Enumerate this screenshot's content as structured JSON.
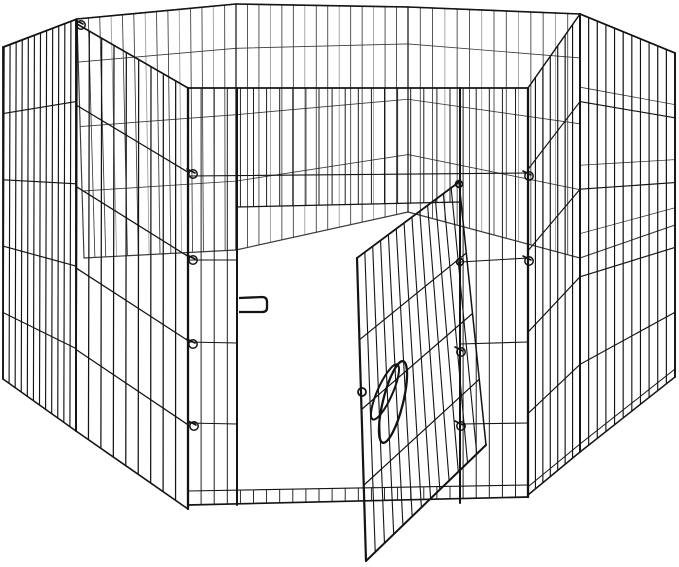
{
  "scene": {
    "description": "Product photo: black metal wire 8-panel octagonal pet exercise playpen with open swing-through door, on white background",
    "canvas": {
      "width": 679,
      "height": 567
    },
    "colors": {
      "background": "#ffffff",
      "wire": "#141414",
      "wire_inner": "#3b3b3b",
      "wire_light": "#9a9a9a"
    }
  },
  "pen": {
    "rim": {
      "pts": [
        [
          3,
          47
        ],
        [
          77,
          19
        ],
        [
          236,
          4
        ],
        [
          408,
          7
        ],
        [
          580,
          14
        ],
        [
          675,
          53
        ]
      ],
      "w": 1.6
    },
    "interior_panels": [
      {
        "name": "back-left-panel",
        "q": [
          [
            77,
            19
          ],
          [
            236,
            4
          ],
          [
            236,
            250
          ],
          [
            84,
            258
          ]
        ],
        "nv": 13,
        "fracs": [
          0.18,
          0.45,
          0.72
        ],
        "w": 0.85,
        "mix": true
      },
      {
        "name": "back-middle-panel",
        "q": [
          [
            236,
            4
          ],
          [
            408,
            7
          ],
          [
            408,
            212
          ],
          [
            236,
            250
          ]
        ],
        "nv": 14,
        "fracs": [
          0.18,
          0.45,
          0.72
        ],
        "w": 0.85,
        "mix": true
      },
      {
        "name": "back-right-panel",
        "q": [
          [
            408,
            7
          ],
          [
            580,
            14
          ],
          [
            580,
            258
          ],
          [
            408,
            212
          ]
        ],
        "nv": 13,
        "fracs": [
          0.18,
          0.45,
          0.72
        ],
        "w": 0.85,
        "mix": true
      },
      {
        "name": "right-inner-panel",
        "q": [
          [
            580,
            14
          ],
          [
            675,
            53
          ],
          [
            675,
            225
          ],
          [
            580,
            258
          ]
        ],
        "nv": 10,
        "fracs": [
          0.3,
          0.62,
          0.9
        ],
        "w": 0.8,
        "mix": true
      }
    ],
    "outer_panels": [
      {
        "name": "left-end-panel",
        "q": [
          [
            4,
            47
          ],
          [
            77,
            19
          ],
          [
            76,
            431
          ],
          [
            3,
            379
          ]
        ],
        "nv": 11,
        "fracs": [
          0.2,
          0.4,
          0.6,
          0.8
        ],
        "w": 1.15
      },
      {
        "name": "left-front-panel",
        "q": [
          [
            77,
            24
          ],
          [
            188,
            88
          ],
          [
            188,
            509
          ],
          [
            76,
            431
          ]
        ],
        "nv": 8,
        "fracs": [
          0.2,
          0.4,
          0.6,
          0.8
        ],
        "w": 1.25
      },
      {
        "name": "right-front-panel",
        "q": [
          [
            528,
            88
          ],
          [
            580,
            14
          ],
          [
            580,
            452
          ],
          [
            528,
            495
          ]
        ],
        "nv": 6,
        "fracs": [
          0.2,
          0.4,
          0.6,
          0.8
        ],
        "w": 1.15
      },
      {
        "name": "right-end-panel",
        "q": [
          [
            580,
            14
          ],
          [
            675,
            53
          ],
          [
            675,
            377
          ],
          [
            580,
            452
          ]
        ],
        "nv": 10,
        "fracs": [
          0.2,
          0.4,
          0.6,
          0.8
        ],
        "w": 1.15
      }
    ],
    "front": {
      "x0": 188,
      "x1": 528,
      "top": 88,
      "botL": 505,
      "botR": 497,
      "rail2": [
        [
          188,
          176
        ],
        [
          528,
          173
        ]
      ],
      "section_rails": [
        [
          [
            188,
            260
          ],
          [
            237,
            260
          ]
        ],
        [
          [
            460,
            262
          ],
          [
            528,
            258
          ]
        ],
        [
          [
            188,
            342
          ],
          [
            237,
            343
          ]
        ],
        [
          [
            460,
            344
          ],
          [
            528,
            342
          ]
        ],
        [
          [
            188,
            423
          ],
          [
            237,
            424
          ]
        ],
        [
          [
            460,
            424
          ],
          [
            528,
            423
          ]
        ]
      ],
      "opening": {
        "x0": 237,
        "x1": 460,
        "header": [
          [
            237,
            207
          ],
          [
            460,
            202
          ]
        ]
      },
      "threshold": [
        [
          188,
          491
        ],
        [
          528,
          485
        ]
      ],
      "wire_step": 13.1,
      "posts": {
        "doorframe_left": 237,
        "doorframe_right": 460
      }
    },
    "posts": [
      {
        "p": [
          [
            3,
            47
          ],
          [
            3,
            379
          ]
        ],
        "w": 1.8
      },
      {
        "p": [
          [
            76,
            20
          ],
          [
            76,
            431
          ]
        ],
        "w": 1.9
      },
      {
        "p": [
          [
            188,
            88
          ],
          [
            188,
            509
          ]
        ],
        "w": 2.3
      },
      {
        "p": [
          [
            237,
            88
          ],
          [
            237,
            505
          ]
        ],
        "w": 2.0
      },
      {
        "p": [
          [
            460,
            88
          ],
          [
            460,
            503
          ]
        ],
        "w": 2.0
      },
      {
        "p": [
          [
            528,
            88
          ],
          [
            528,
            497
          ]
        ],
        "w": 2.3
      },
      {
        "p": [
          [
            580,
            14
          ],
          [
            580,
            452
          ]
        ],
        "w": 1.9
      },
      {
        "p": [
          [
            675,
            53
          ],
          [
            675,
            377
          ]
        ],
        "w": 1.9
      },
      {
        "p": [
          [
            236,
            4
          ],
          [
            236,
            250
          ]
        ],
        "w": 1.0
      },
      {
        "p": [
          [
            408,
            7
          ],
          [
            408,
            212
          ]
        ],
        "w": 1.0
      }
    ],
    "extra_lines": [
      {
        "p": [
          [
            188,
            88
          ],
          [
            528,
            88
          ]
        ],
        "w": 1.7
      },
      {
        "p": [
          [
            529,
            486
          ],
          [
            580,
            444
          ]
        ],
        "w": 1.0
      },
      {
        "p": [
          [
            580,
            444
          ],
          [
            675,
            369
          ]
        ],
        "w": 1.0
      }
    ],
    "door": {
      "name": "open-door-panel",
      "q": [
        [
          459,
          182
        ],
        [
          357,
          258
        ],
        [
          366,
          561
        ],
        [
          486,
          445
        ]
      ],
      "nv": 12,
      "fracs": [
        0,
        0.27,
        0.5,
        0.75,
        1
      ],
      "w": 1.1,
      "edge_w": {
        "top": 1.8,
        "far": 2.2,
        "bottom": 2.0,
        "hinge": 1.5
      },
      "hinges": [
        [
          459,
          184
        ],
        [
          460,
          262
        ]
      ]
    },
    "latch": {
      "loop_outer": {
        "cx": 393,
        "cy": 402,
        "rx": 10,
        "ry": 42,
        "rot": 14,
        "w": 2.3
      },
      "loop_inner": {
        "cx": 385,
        "cy": 392,
        "rx": 7.5,
        "ry": 30,
        "rot": 24,
        "w": 2.0
      },
      "ring": {
        "x": 362,
        "y": 392,
        "r": 4,
        "w": 1.8
      }
    },
    "handle": {
      "x0": 239,
      "x1": 267,
      "yTop": 297,
      "yBot": 312,
      "w": 2.3
    },
    "clips": [
      [
        190,
        171
      ],
      [
        190,
        257
      ],
      [
        190,
        341
      ],
      [
        191,
        423
      ],
      [
        526,
        173
      ],
      [
        526,
        258
      ],
      [
        458,
        349
      ],
      [
        458,
        423
      ],
      [
        78,
        22
      ]
    ]
  }
}
